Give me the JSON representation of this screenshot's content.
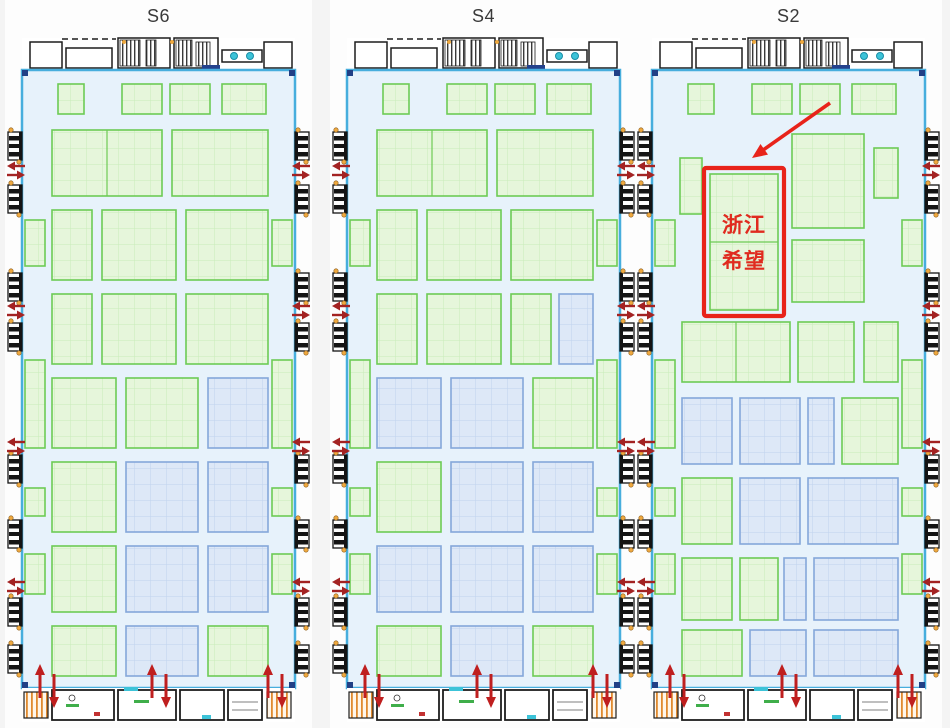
{
  "page": {
    "background": "#f4f4f4",
    "panel": "#fdfdfd"
  },
  "colors": {
    "hall_bg": "#e7f2fb",
    "wall": "#47aedd",
    "wall_corner": "#214086",
    "green_fill": "#e6f6db",
    "green_grid": "#c8ecb9",
    "green_border": "#6dcb55",
    "blue_fill": "#dde8f7",
    "blue_grid": "#c0d2ee",
    "blue_border": "#84a7da",
    "facility_stroke": "#1d1d1d",
    "stair_hatch": "#e08a2f",
    "cyan_fixture": "#3cc3d8",
    "navy_fixture": "#24418c",
    "orange_dot": "#efa93f",
    "door_black": "#141414",
    "exit_arrow_red": "#a32222",
    "entrance_arrow_red": "#bf1f1f",
    "annotation_red": "#e8231a",
    "label_red": "#e02b1f",
    "title_color": "#3a3a3a",
    "green_label": "#3fae4a",
    "red_mark": "#c23232"
  },
  "shared": {
    "interior": {
      "w": 273,
      "h": 618
    },
    "door_ys": [
      62,
      115,
      203,
      253,
      385,
      450,
      528,
      575
    ],
    "edge_booths": [
      [
        150,
        46
      ],
      [
        290,
        88
      ],
      [
        418,
        28
      ],
      [
        484,
        40
      ]
    ],
    "side_arrow_ys": [
      100,
      240,
      376,
      516
    ],
    "bottom_arrow_xs": [
      18,
      130,
      246
    ]
  },
  "halls": [
    {
      "title": "S6",
      "left": 6,
      "booths": [
        [
          36,
          14,
          26,
          30,
          "g"
        ],
        [
          100,
          14,
          40,
          30,
          "g"
        ],
        [
          148,
          14,
          40,
          30,
          "g"
        ],
        [
          200,
          14,
          44,
          30,
          "g"
        ],
        [
          30,
          60,
          110,
          66,
          "g"
        ],
        [
          150,
          60,
          96,
          66,
          "g"
        ],
        [
          30,
          140,
          40,
          70,
          "g"
        ],
        [
          80,
          140,
          74,
          70,
          "g"
        ],
        [
          164,
          140,
          82,
          70,
          "g"
        ],
        [
          30,
          224,
          40,
          70,
          "g"
        ],
        [
          80,
          224,
          74,
          70,
          "g"
        ],
        [
          164,
          224,
          82,
          70,
          "g"
        ],
        [
          30,
          308,
          64,
          70,
          "g"
        ],
        [
          104,
          308,
          72,
          70,
          "g"
        ],
        [
          186,
          308,
          60,
          70,
          "b"
        ],
        [
          30,
          392,
          64,
          70,
          "g"
        ],
        [
          104,
          392,
          72,
          70,
          "b"
        ],
        [
          186,
          392,
          60,
          70,
          "b"
        ],
        [
          30,
          476,
          64,
          66,
          "g"
        ],
        [
          104,
          476,
          72,
          66,
          "b"
        ],
        [
          186,
          476,
          60,
          66,
          "b"
        ],
        [
          30,
          556,
          64,
          50,
          "g"
        ],
        [
          104,
          556,
          72,
          50,
          "b"
        ],
        [
          186,
          556,
          60,
          50,
          "g"
        ]
      ]
    },
    {
      "title": "S4",
      "left": 331,
      "booths": [
        [
          36,
          14,
          26,
          30,
          "g"
        ],
        [
          100,
          14,
          40,
          30,
          "g"
        ],
        [
          148,
          14,
          40,
          30,
          "g"
        ],
        [
          200,
          14,
          44,
          30,
          "g"
        ],
        [
          30,
          60,
          110,
          66,
          "g"
        ],
        [
          150,
          60,
          96,
          66,
          "g"
        ],
        [
          30,
          140,
          40,
          70,
          "g"
        ],
        [
          80,
          140,
          74,
          70,
          "g"
        ],
        [
          164,
          140,
          82,
          70,
          "g"
        ],
        [
          30,
          224,
          40,
          70,
          "g"
        ],
        [
          80,
          224,
          74,
          70,
          "g"
        ],
        [
          164,
          224,
          40,
          70,
          "g"
        ],
        [
          212,
          224,
          34,
          70,
          "b"
        ],
        [
          30,
          308,
          64,
          70,
          "b"
        ],
        [
          104,
          308,
          72,
          70,
          "b"
        ],
        [
          186,
          308,
          60,
          70,
          "g"
        ],
        [
          30,
          392,
          64,
          70,
          "g"
        ],
        [
          104,
          392,
          72,
          70,
          "b"
        ],
        [
          186,
          392,
          60,
          70,
          "b"
        ],
        [
          30,
          476,
          64,
          66,
          "b"
        ],
        [
          104,
          476,
          72,
          66,
          "b"
        ],
        [
          186,
          476,
          60,
          66,
          "b"
        ],
        [
          30,
          556,
          64,
          50,
          "g"
        ],
        [
          104,
          556,
          72,
          50,
          "b"
        ],
        [
          186,
          556,
          60,
          50,
          "g"
        ]
      ]
    },
    {
      "title": "S2",
      "left": 636,
      "booths": [
        [
          36,
          14,
          26,
          30,
          "g"
        ],
        [
          100,
          14,
          40,
          30,
          "g"
        ],
        [
          148,
          14,
          40,
          30,
          "g"
        ],
        [
          200,
          14,
          44,
          30,
          "g"
        ],
        [
          28,
          88,
          22,
          56,
          "g"
        ],
        [
          58,
          104,
          68,
          136,
          "g"
        ],
        [
          140,
          64,
          72,
          94,
          "g"
        ],
        [
          222,
          78,
          24,
          50,
          "g"
        ],
        [
          140,
          170,
          72,
          62,
          "g"
        ],
        [
          30,
          252,
          108,
          60,
          "g"
        ],
        [
          146,
          252,
          56,
          60,
          "g"
        ],
        [
          212,
          252,
          34,
          60,
          "g"
        ],
        [
          30,
          328,
          50,
          66,
          "b"
        ],
        [
          88,
          328,
          60,
          66,
          "b"
        ],
        [
          156,
          328,
          26,
          66,
          "b"
        ],
        [
          190,
          328,
          56,
          66,
          "g"
        ],
        [
          30,
          408,
          50,
          66,
          "g"
        ],
        [
          88,
          408,
          60,
          66,
          "b"
        ],
        [
          156,
          408,
          90,
          66,
          "b"
        ],
        [
          30,
          488,
          50,
          62,
          "g"
        ],
        [
          88,
          488,
          38,
          62,
          "g"
        ],
        [
          132,
          488,
          22,
          62,
          "b"
        ],
        [
          162,
          488,
          84,
          62,
          "b"
        ],
        [
          30,
          560,
          60,
          46,
          "g"
        ],
        [
          98,
          560,
          56,
          46,
          "b"
        ],
        [
          162,
          560,
          84,
          46,
          "b"
        ]
      ]
    }
  ],
  "annotation": {
    "hall": "S2",
    "line1": "浙江",
    "line2": "希望",
    "highlight": {
      "x": 52,
      "y": 98,
      "w": 80,
      "h": 148
    },
    "arrow": {
      "x1": 178,
      "y1": 33,
      "x2": 100,
      "y2": 88
    }
  }
}
